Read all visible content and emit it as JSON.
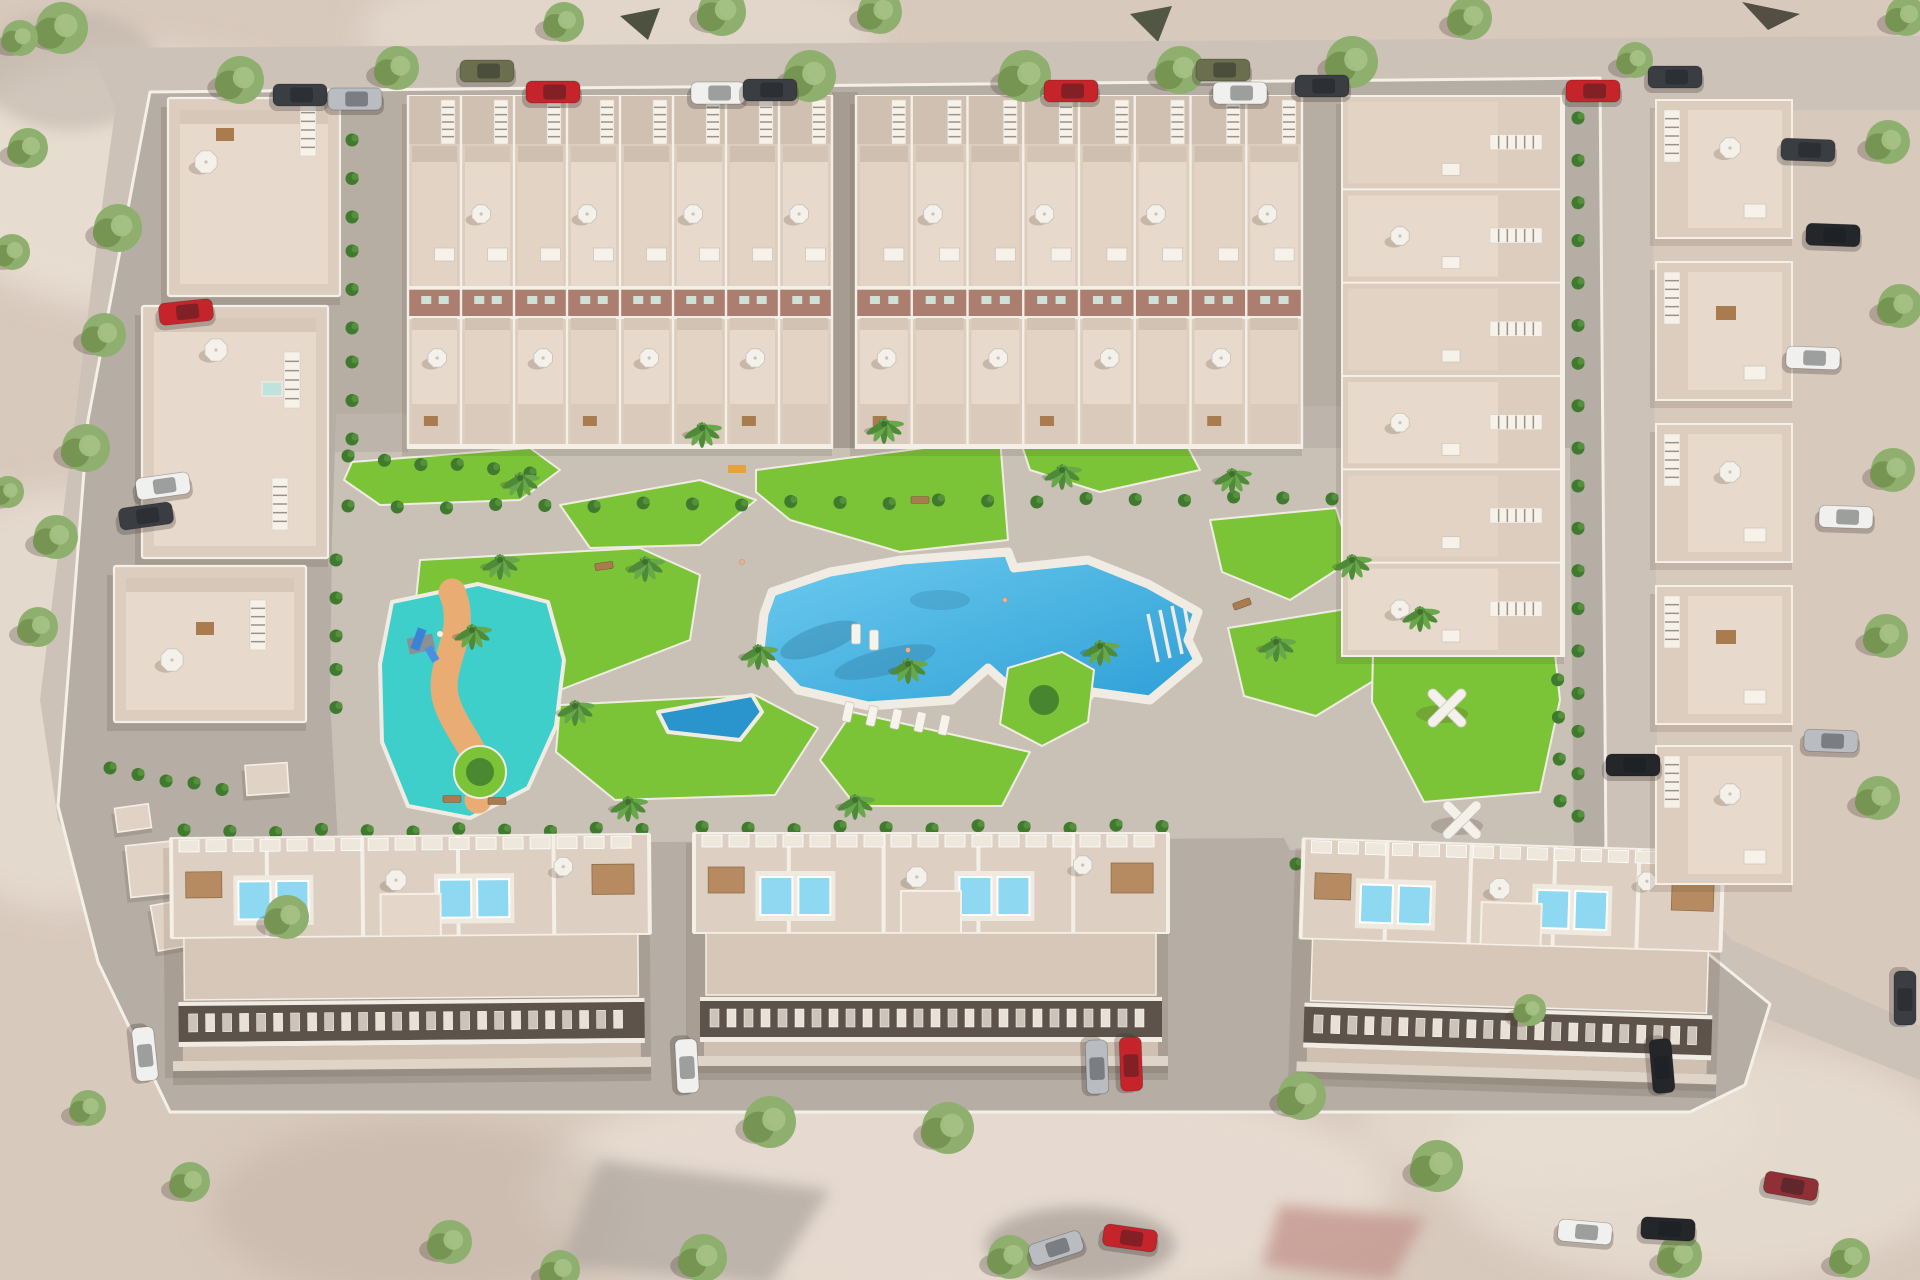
{
  "scene": {
    "colors": {
      "terrain": "#d8c9bd",
      "terrain_light": "#eadfd4",
      "terrain_dark": "#c2b2a5",
      "street": "#ccc2b8",
      "road": "#b6ada4",
      "plaza": "#c9c0b6",
      "alley": "#a79c91",
      "sidewalk": "#e8e1d6",
      "wall": "#f4efe7",
      "building": "#dccdbf",
      "terrace": "#e7d9cb",
      "terrace_alt": "#e2d3c4",
      "north_strip": "#cfc0b2",
      "facade_band": "#ab7e70",
      "band_window": "#cfe0d6",
      "window_band": "#5d534b",
      "window_lit": "#e9e1d5",
      "window_dim": "#cdc3b8",
      "pool_light": "#6ccbee",
      "pool_deep": "#2d9ed6",
      "pool_wedge": "#2a95cc",
      "kids_pool": "#3fcfca",
      "kids_path": "#e9ad74",
      "roof_pool": "#8fd8f2",
      "deck": "#f1ece3",
      "lawn": "#7cc437",
      "hedge": "#3f7a2e",
      "tree": "#8faf6e",
      "tree_light": "#a8c487",
      "tree_dark": "#74924f",
      "palm": "#4e8a38",
      "umbrella": "#f4f1ea",
      "umbrella_edge": "#c9c2b8",
      "pergola": "#b5885c",
      "table": "#a97c4f",
      "stair": "#f6f2ea",
      "stair_rung": "#9c9186",
      "shadow": "rgba(80,62,50,0.22)",
      "car_white": "#f0f0ee",
      "car_silver": "#b9bcc0",
      "car_red": "#c6242b",
      "car_dark": "#3a3d41",
      "car_black": "#24262a",
      "car_olive": "#6b6f4e",
      "car_darkred": "#8e3036"
    },
    "top_blocks": [
      {
        "x": 408,
        "y": 96,
        "w": 424,
        "units": 8
      },
      {
        "x": 856,
        "y": 96,
        "w": 446,
        "units": 8
      }
    ],
    "left_apartments": [
      {
        "x": 168,
        "y": 98,
        "w": 172,
        "h": 198,
        "stair": [
          300,
          104,
          16,
          52
        ],
        "umb": [
          [
            206,
            162
          ]
        ],
        "tables": [
          [
            216,
            128
          ]
        ]
      },
      {
        "x": 142,
        "y": 306,
        "w": 186,
        "h": 252,
        "stair": [
          284,
          352,
          16,
          56
        ],
        "stair2": [
          272,
          478,
          16,
          52
        ],
        "umb": [
          [
            216,
            350
          ]
        ],
        "sky": [
          [
            262,
            382
          ]
        ]
      },
      {
        "x": 114,
        "y": 566,
        "w": 192,
        "h": 156,
        "stair": [
          250,
          600,
          16,
          50
        ],
        "umb": [
          [
            172,
            660
          ]
        ],
        "tables": [
          [
            196,
            622
          ]
        ]
      }
    ],
    "right_column": {
      "x": 1342,
      "y": 96,
      "w": 222,
      "h": 560,
      "rows": 6
    },
    "bottom_blocks": [
      {
        "x": 172,
        "y": 836,
        "w": 478,
        "rot": -0.5
      },
      {
        "x": 694,
        "y": 833,
        "w": 474,
        "rot": 0
      },
      {
        "x": 1300,
        "y": 845,
        "w": 420,
        "rot": 1.8
      }
    ],
    "east_villas": {
      "x": 1656,
      "w": 136,
      "h": 138,
      "ys": [
        100,
        262,
        424,
        586,
        746
      ]
    },
    "utility_boxes": [
      [
        128,
        842,
        70,
        52,
        -6
      ],
      [
        154,
        900,
        62,
        46,
        -10
      ],
      [
        246,
        764,
        42,
        30,
        -4
      ],
      [
        116,
        806,
        34,
        24,
        -8
      ]
    ],
    "pergolas_x": [
      [
        1403,
        625
      ],
      [
        1447,
        708
      ],
      [
        1462,
        820
      ]
    ],
    "benches": [
      [
        604,
        566,
        -8
      ],
      [
        452,
        799,
        0
      ],
      [
        497,
        801,
        0
      ],
      [
        1242,
        604,
        -20
      ],
      [
        920,
        500,
        0
      ]
    ],
    "towels": [
      [
        737,
        469
      ]
    ],
    "people": [
      [
        1005,
        600
      ],
      [
        908,
        650
      ],
      [
        742,
        562
      ]
    ],
    "loungers": [
      [
        848,
        712,
        12
      ],
      [
        872,
        716,
        12
      ],
      [
        896,
        719,
        12
      ],
      [
        920,
        722,
        12
      ],
      [
        944,
        725,
        12
      ],
      [
        856,
        634,
        0
      ],
      [
        874,
        640,
        0
      ],
      [
        246,
        187,
        20
      ],
      [
        268,
        193,
        20
      ],
      [
        212,
        627,
        14
      ]
    ],
    "bush_lines": [
      [
        352,
        140,
        352,
        436,
        36
      ],
      [
        348,
        506,
        1332,
        496,
        50
      ],
      [
        1578,
        118,
        1578,
        854,
        40
      ],
      [
        184,
        830,
        642,
        828,
        46
      ],
      [
        702,
        827,
        1162,
        825,
        46
      ],
      [
        1296,
        864,
        1744,
        872,
        46
      ],
      [
        1374,
        598,
        1548,
        590,
        40
      ],
      [
        1556,
        596,
        1560,
        798,
        40
      ],
      [
        336,
        560,
        336,
        706,
        34
      ],
      [
        110,
        768,
        222,
        788,
        30
      ],
      [
        348,
        456,
        530,
        470,
        34
      ]
    ],
    "palms": [
      [
        520,
        478
      ],
      [
        702,
        428
      ],
      [
        884,
        424
      ],
      [
        645,
        562
      ],
      [
        758,
        650
      ],
      [
        908,
        664
      ],
      [
        1062,
        470
      ],
      [
        1232,
        474
      ],
      [
        1100,
        646
      ],
      [
        575,
        706
      ],
      [
        500,
        560
      ],
      [
        1276,
        642
      ],
      [
        1420,
        612
      ],
      [
        628,
        802
      ],
      [
        855,
        800
      ],
      [
        1352,
        560
      ],
      [
        472,
        630
      ]
    ],
    "trees": [
      [
        240,
        80,
        24
      ],
      [
        397,
        68,
        22
      ],
      [
        564,
        22,
        20
      ],
      [
        722,
        12,
        24
      ],
      [
        810,
        76,
        26
      ],
      [
        1025,
        76,
        26
      ],
      [
        1180,
        70,
        24
      ],
      [
        1352,
        62,
        26
      ],
      [
        1470,
        18,
        22
      ],
      [
        880,
        12,
        22
      ],
      [
        62,
        28,
        26
      ],
      [
        1906,
        16,
        20
      ],
      [
        1635,
        60,
        18
      ],
      [
        118,
        228,
        24
      ],
      [
        104,
        335,
        22
      ],
      [
        86,
        448,
        24
      ],
      [
        56,
        537,
        22
      ],
      [
        38,
        627,
        20
      ],
      [
        12,
        252,
        18
      ],
      [
        28,
        148,
        20
      ],
      [
        8,
        492,
        16
      ],
      [
        20,
        38,
        18
      ],
      [
        287,
        917,
        22
      ],
      [
        770,
        1122,
        26
      ],
      [
        948,
        1128,
        26
      ],
      [
        703,
        1258,
        24
      ],
      [
        450,
        1242,
        22
      ],
      [
        1010,
        1257,
        22
      ],
      [
        1302,
        1096,
        24
      ],
      [
        1437,
        1166,
        26
      ],
      [
        1680,
        1256,
        22
      ],
      [
        190,
        1182,
        20
      ],
      [
        88,
        1108,
        18
      ],
      [
        560,
        1270,
        20
      ],
      [
        1888,
        142,
        22
      ],
      [
        1900,
        306,
        22
      ],
      [
        1893,
        470,
        22
      ],
      [
        1886,
        636,
        22
      ],
      [
        1878,
        798,
        22
      ],
      [
        1530,
        1010,
        16
      ],
      [
        1850,
        1258,
        20
      ]
    ],
    "cars": [
      [
        300,
        95,
        0,
        "dark"
      ],
      [
        355,
        99,
        0,
        "silver"
      ],
      [
        487,
        71,
        0,
        "olive"
      ],
      [
        553,
        92,
        0,
        "red"
      ],
      [
        718,
        93,
        0,
        "white"
      ],
      [
        770,
        90,
        0,
        "dark"
      ],
      [
        1071,
        91,
        0,
        "red"
      ],
      [
        1223,
        70,
        0,
        "olive"
      ],
      [
        1240,
        93,
        0,
        "white"
      ],
      [
        1322,
        86,
        0,
        "dark"
      ],
      [
        1593,
        91,
        0,
        "red"
      ],
      [
        1675,
        77,
        0,
        "dark"
      ],
      [
        186,
        312,
        -6,
        "red"
      ],
      [
        163,
        486,
        -8,
        "white"
      ],
      [
        146,
        516,
        -8,
        "dark"
      ],
      [
        1808,
        150,
        2,
        "dark"
      ],
      [
        1833,
        235,
        2,
        "black"
      ],
      [
        1813,
        358,
        2,
        "white"
      ],
      [
        1846,
        517,
        2,
        "white"
      ],
      [
        1831,
        741,
        2,
        "silver"
      ],
      [
        1633,
        765,
        0,
        "black"
      ],
      [
        1905,
        998,
        90,
        "dark"
      ],
      [
        145,
        1054,
        84,
        "white"
      ],
      [
        687,
        1066,
        87,
        "white"
      ],
      [
        1097,
        1067,
        88,
        "silver"
      ],
      [
        1131,
        1064,
        88,
        "red"
      ],
      [
        1662,
        1066,
        85,
        "black"
      ],
      [
        1585,
        1232,
        5,
        "white"
      ],
      [
        1668,
        1229,
        3,
        "black"
      ],
      [
        1130,
        1238,
        8,
        "red"
      ],
      [
        1056,
        1248,
        -18,
        "silver"
      ],
      [
        1791,
        1186,
        10,
        "darkred"
      ]
    ]
  }
}
